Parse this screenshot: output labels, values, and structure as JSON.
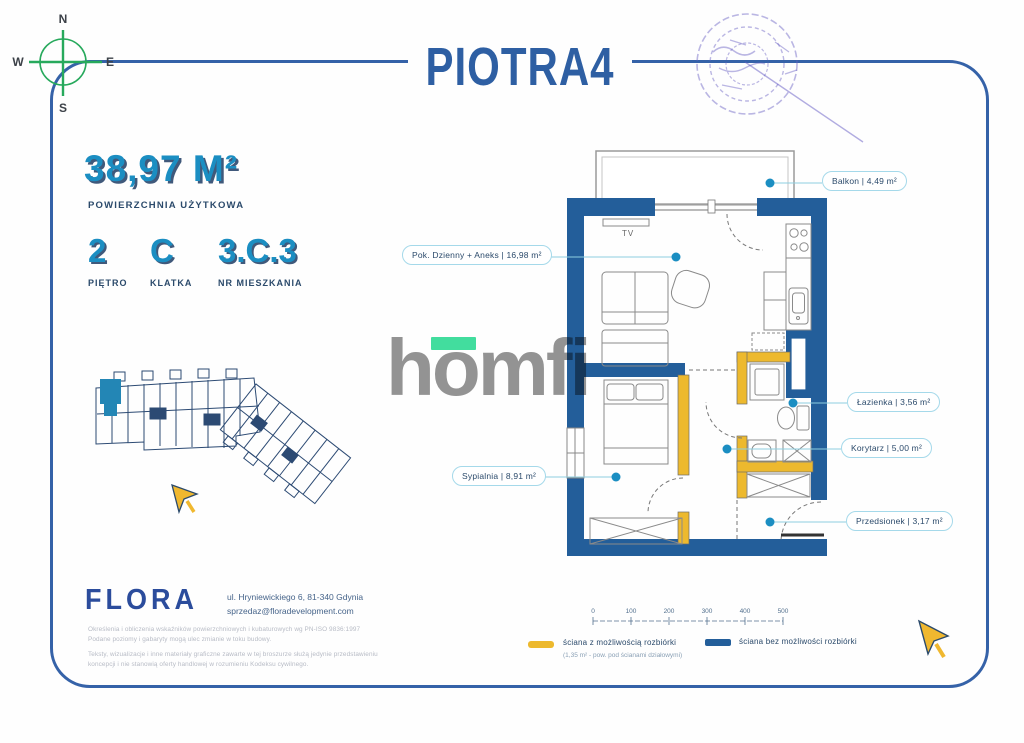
{
  "page": {
    "title": "PIOTRA4"
  },
  "compass": {
    "n": "N",
    "e": "E",
    "s": "S",
    "w": "W"
  },
  "stats": {
    "area_value": "38,97 M²",
    "area_label": "POWIERZCHNIA UŻYTKOWA",
    "floor_value": "2",
    "floor_label": "PIĘTRO",
    "staircase_value": "C",
    "staircase_label": "KLATKA",
    "apartment_value": "3.C.3",
    "apartment_label": "NR MIESZKANIA"
  },
  "watermark": {
    "text": "homfi"
  },
  "plan": {
    "tv": "TV",
    "rooms": {
      "balkon": "Balkon | 4,49 m²",
      "pok_dzienny": "Pok. Dzienny + Aneks | 16,98 m²",
      "lazienka": "Łazienka | 3,56 m²",
      "korytarz": "Korytarz | 5,00 m²",
      "przedsionek": "Przedsionek | 3,17 m²",
      "sypialnia": "Sypialnia | 8,91 m²"
    }
  },
  "scale_bar": {
    "ticks": [
      "0",
      "100",
      "200",
      "300",
      "400",
      "500"
    ]
  },
  "legend": {
    "demolishable": "ściana z możliwością rozbiórki",
    "demolishable_note": "(1,35 m² - pow. pod ścianami działowymi)",
    "permanent": "ściana bez możliwości rozbiórki"
  },
  "footer": {
    "brand": "FLORA",
    "address": "ul. Hryniewickiego 6, 81-340 Gdynia",
    "email": "sprzedaz@floradevelopment.com",
    "disclaimer_line1": "Określenia i obliczenia wskaźników powierzchniowych i kubaturowych wg PN-ISO 9836:1997",
    "disclaimer_line2": "Podane poziomy i gabaryty mogą ulec zmianie w toku budowy.",
    "disclaimer_line3": "Teksty, wizualizacje i inne materiały graficzne zawarte w tej broszurze służą jedynie przedstawieniu",
    "disclaimer_line4": "koncepcji i nie stanowią oferty handlowej w rozumieniu Kodeksu cywilnego."
  },
  "colors": {
    "wall_permanent": "#235e9a",
    "wall_demolishable": "#edb92e",
    "accent": "#1b8ec2",
    "card_border": "#3562a8",
    "compass_green": "#27a95c",
    "mint": "#42dd9e"
  }
}
